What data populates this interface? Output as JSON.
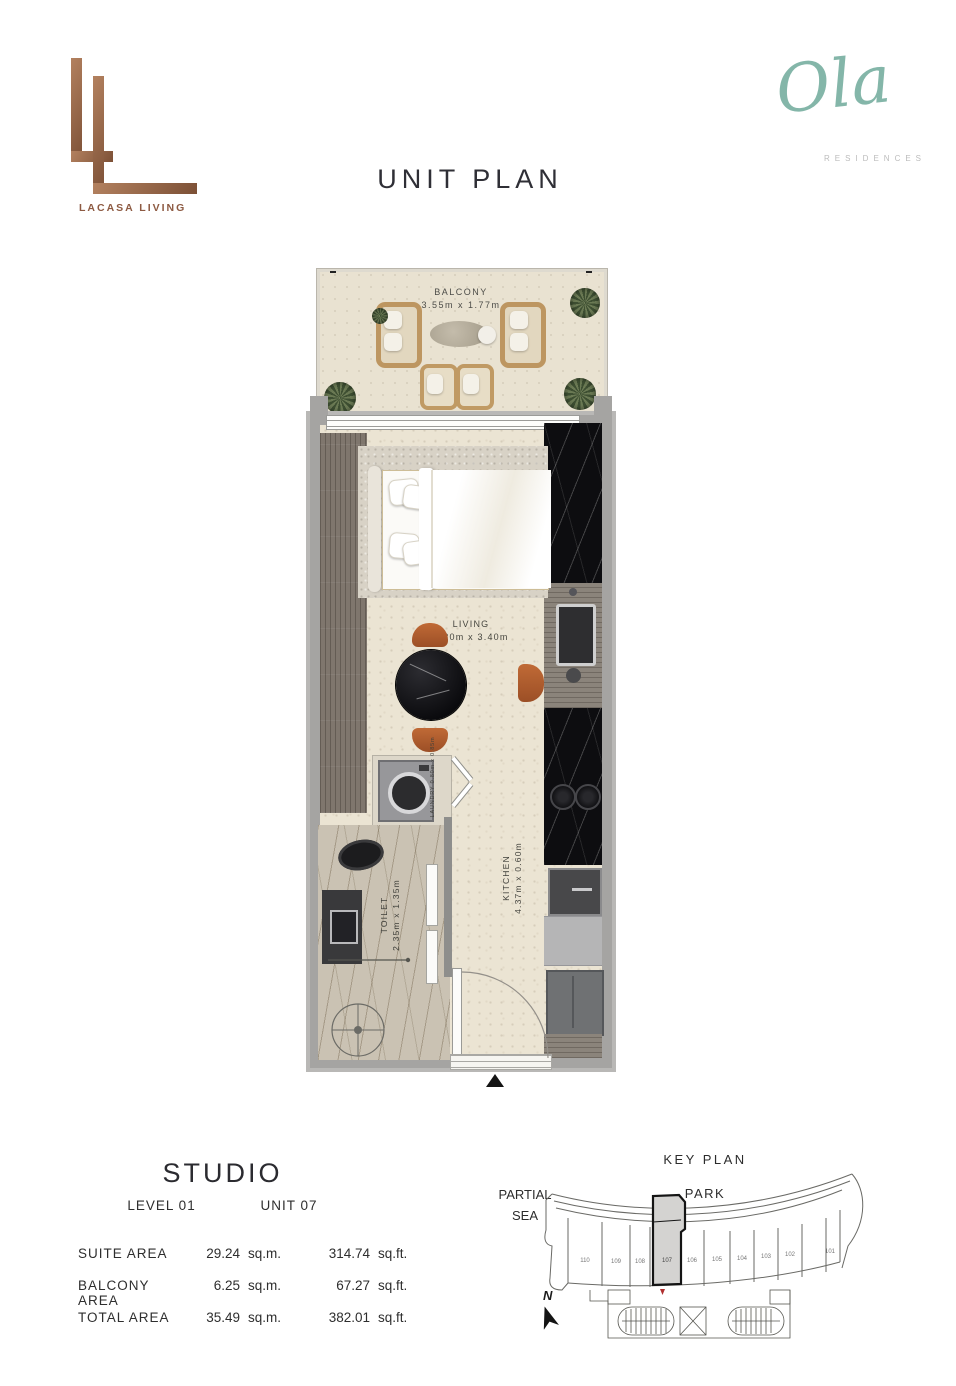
{
  "page": {
    "title": "UNIT PLAN"
  },
  "brand_lacasa": {
    "name": "LACASA LIVING"
  },
  "brand_ola": {
    "script": "Ola",
    "subtitle": "RESIDENCES"
  },
  "plan": {
    "balcony": {
      "name": "BALCONY",
      "dims": "3.55m x 1.77m"
    },
    "living": {
      "name": "LIVING",
      "dims": "4.20m x 3.40m"
    },
    "kitchen": {
      "name": "KITCHEN",
      "dims": "4.37m x 0.60m"
    },
    "laundry": {
      "name": "LAUNDRY",
      "dims": "0.80m x 0.85m"
    },
    "toilet": {
      "name": "TOILET",
      "dims": "2.35m x 1.35m"
    }
  },
  "unit_info": {
    "type_label": "STUDIO",
    "level_label": "LEVEL 01",
    "unit_label": "UNIT 07",
    "rows": [
      {
        "label": "SUITE AREA",
        "sqm": "29.24",
        "sqm_unit": "sq.m.",
        "sqft": "314.74",
        "sqft_unit": "sq.ft."
      },
      {
        "label": "BALCONY AREA",
        "sqm": "6.25",
        "sqm_unit": "sq.m.",
        "sqft": "67.27",
        "sqft_unit": "sq.ft."
      },
      {
        "label": "TOTAL AREA",
        "sqm": "35.49",
        "sqm_unit": "sq.m.",
        "sqft": "382.01",
        "sqft_unit": "sq.ft."
      }
    ]
  },
  "key_plan": {
    "title": "KEY PLAN",
    "context_left_line1": "PARTIAL",
    "context_left_line2": "SEA",
    "context_top": "PARK",
    "north_label": "N",
    "units": [
      "110",
      "109",
      "108",
      "107",
      "106",
      "105",
      "104",
      "103",
      "102",
      "101"
    ],
    "highlighted_unit": "107"
  },
  "colors": {
    "copper": "#96664d",
    "teal": "#84b6a9",
    "ink": "#33333b",
    "wall_gray": "#a5a4a2",
    "floor_cream": "#ebe4d3",
    "chair_orange": "#b2602f",
    "highlight_red": "#b03030"
  }
}
